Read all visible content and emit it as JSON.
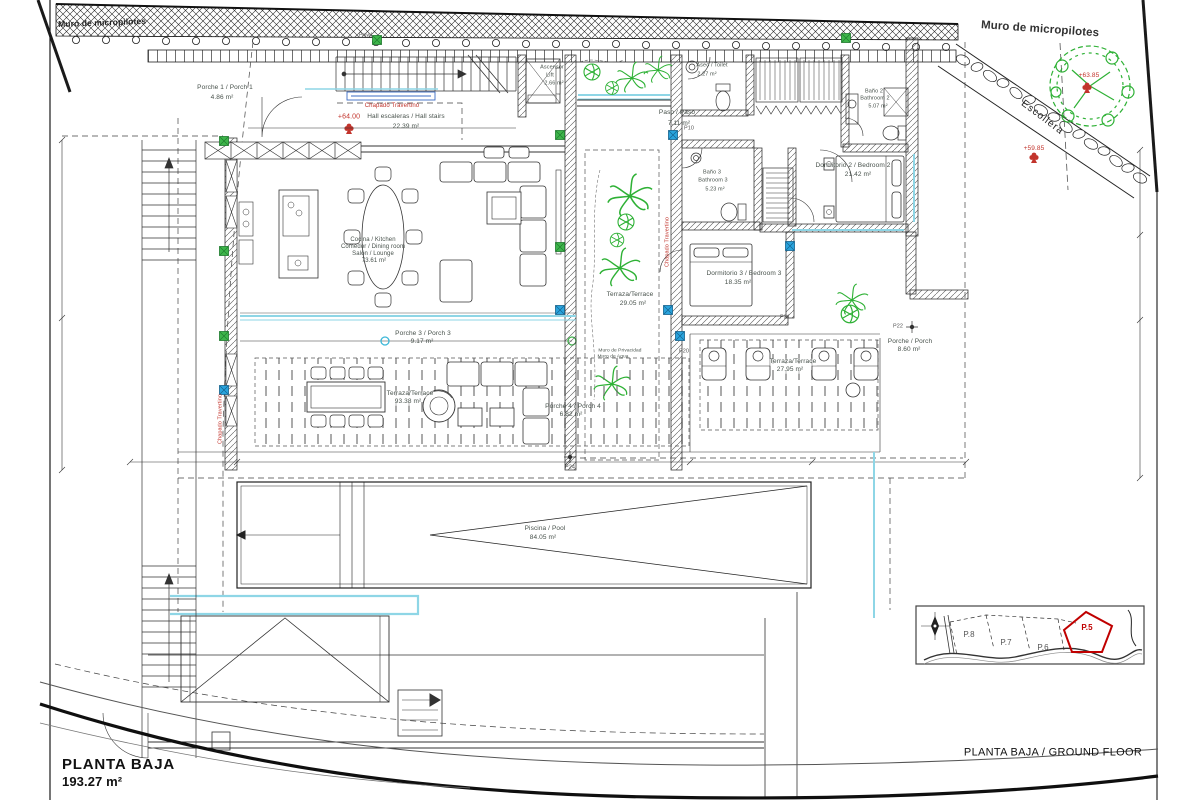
{
  "sheet": {
    "bottom_left_title": "PLANTA BAJA",
    "bottom_left_area": "193.27 m²",
    "bottom_right_title": "PLANTA BAJA / GROUND FLOOR"
  },
  "site": {
    "micropile_wall_left": "Muro de micropilotes",
    "micropile_wall_right": "Muro de micropilotes",
    "rock_wall": "Escollera",
    "level_tree": "+63.85",
    "level_slope": "+59.85",
    "level_hall": "+64.00",
    "pile_label": "Pmw1"
  },
  "finishes": {
    "travertine_hall": "Chapado Travertino",
    "travertine_west": "Chapado Travertino",
    "travertine_terrace": "Chapado Travertino",
    "privacy_wall_1": "Muro de Privacidad",
    "privacy_wall_2": "Muro de Agua"
  },
  "rooms": {
    "porch1": {
      "name": "Porche 1 / Porch 1",
      "area": "4.86 m²"
    },
    "hall": {
      "name": "Hall escaleras / Hall stairs",
      "area": "22.39 m²"
    },
    "lift": {
      "name_es": "Ascensor",
      "name_en": "Lift",
      "area": "2.66 m²"
    },
    "toilet": {
      "name": "Aseo / Toilet",
      "area": "2.27 m²"
    },
    "corridor": {
      "name": "Paso / Paso",
      "area": "7.11 m²"
    },
    "bath2": {
      "name_es": "Baño 2",
      "name_en": "Bathroom 2",
      "area": "5.07 m²"
    },
    "bed2": {
      "name": "Dormitorio 2 / Bedroom 2",
      "area": "21.42 m²"
    },
    "living": {
      "line1": "Cocina / Kitchen",
      "line2": "Comedor / Dining room",
      "line3": "Salón / Lounge",
      "area": "73.61 m²"
    },
    "terrace_center": {
      "name": "Terraza/Terrace",
      "area": "29.05 m²"
    },
    "bath3": {
      "name_es": "Baño 3",
      "name_en": "Bathroom 3",
      "area": "5.23 m²"
    },
    "bed3": {
      "name": "Dormitorio 3 / Bedroom 3",
      "area": "18.35 m²"
    },
    "porch3": {
      "name": "Porche 3 / Porch 3",
      "area": "9.17 m²"
    },
    "terrace_main": {
      "name": "Terraza/Terrace",
      "area": "93.38 m²"
    },
    "porch4": {
      "name": "Porche 4 / Porch 4",
      "area": "6.82 m²"
    },
    "terrace_east": {
      "name": "Terraza/Terrace",
      "area": "27.95 m²"
    },
    "porch_east": {
      "name": "Porche / Porch",
      "area": "8.60 m²"
    },
    "pool": {
      "name": "Piscina / Pool",
      "area": "84.05 m²"
    }
  },
  "markers": {
    "p10": "P10",
    "p20": "P20",
    "p21": "P21",
    "p22": "P22",
    "p24": "P24"
  },
  "inset": {
    "plot8": "P.8",
    "plot7": "P.7",
    "plot6": "P.6",
    "plot5": "P.5"
  },
  "colors": {
    "red_annotation": "#c2342c",
    "plot_highlight": "#c00000",
    "vegetation": "#2eb135",
    "glazing": "#8ed6e6",
    "column_green": "#3db54a",
    "column_blue": "#29a3dc"
  }
}
